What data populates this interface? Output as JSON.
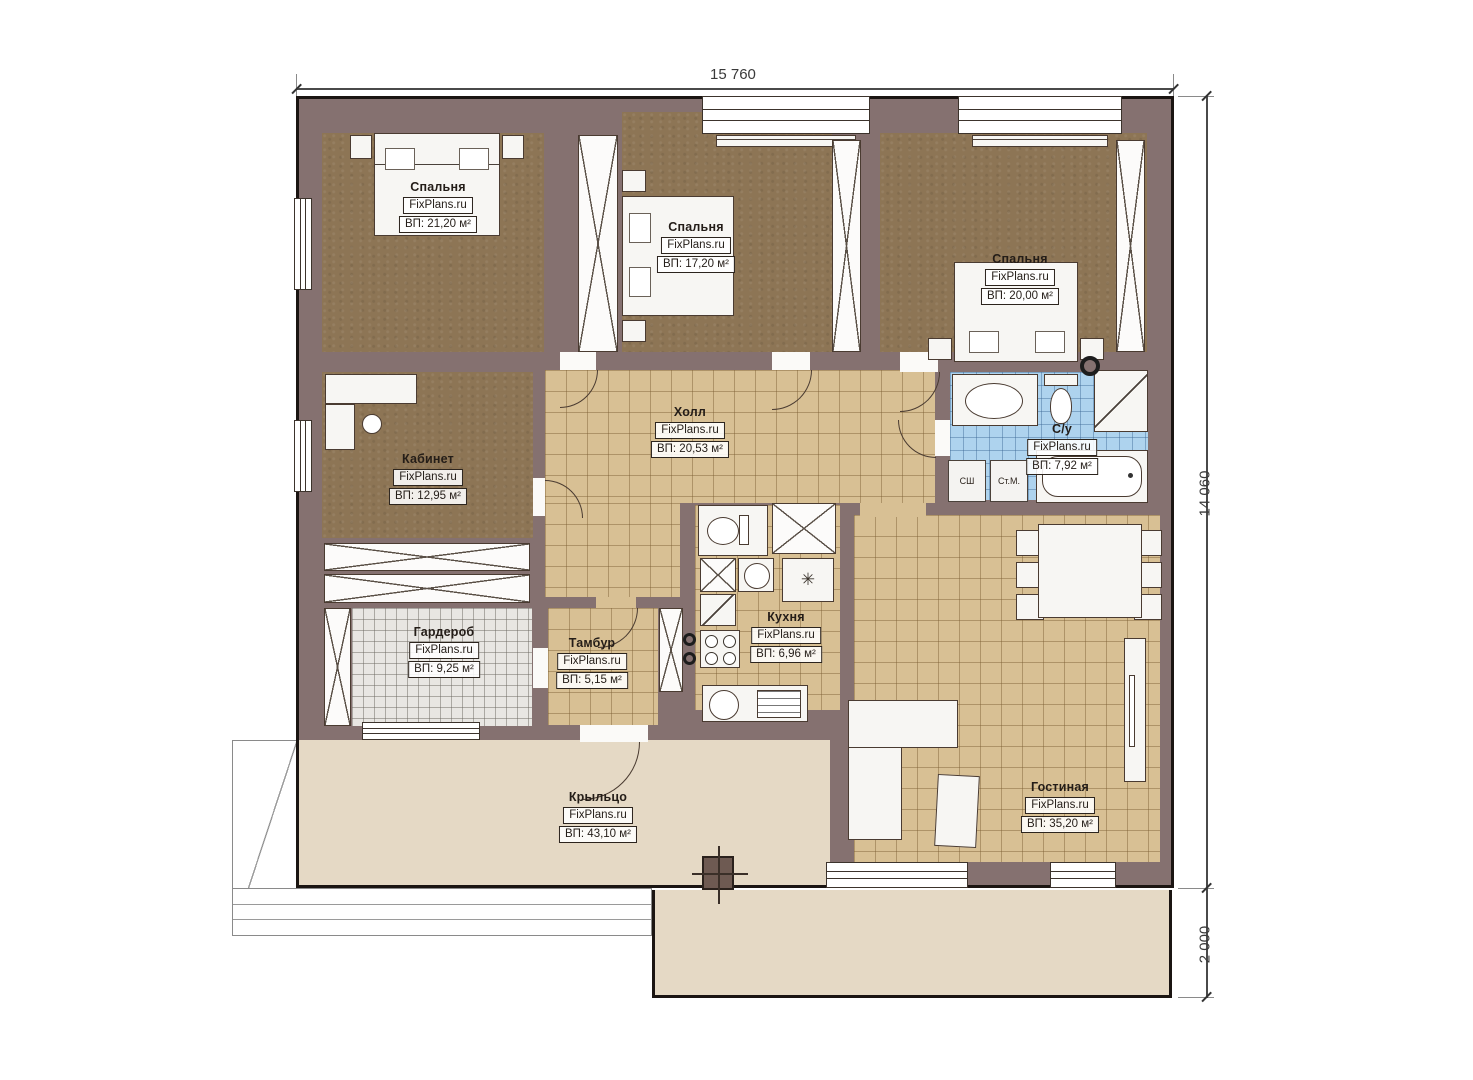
{
  "watermark": "FixPlans.ru",
  "dimensions": {
    "top_width": "15 760",
    "right_height": "14 060",
    "right_terrace": "2 000"
  },
  "rooms": [
    {
      "id": "bedroom-1",
      "name": "Спальня",
      "area": "ВП: 21,20 м²"
    },
    {
      "id": "bedroom-2",
      "name": "Спальня",
      "area": "ВП: 17,20 м²"
    },
    {
      "id": "bedroom-3",
      "name": "Спальня",
      "area": "ВП: 20,00 м²"
    },
    {
      "id": "office",
      "name": "Кабинет",
      "area": "ВП: 12,95 м²"
    },
    {
      "id": "hall",
      "name": "Холл",
      "area": "ВП: 20,53 м²"
    },
    {
      "id": "bathroom",
      "name": "С/у",
      "area": "ВП: 7,92 м²"
    },
    {
      "id": "wardrobe",
      "name": "Гардероб",
      "area": "ВП: 9,25 м²"
    },
    {
      "id": "tambour",
      "name": "Тамбур",
      "area": "ВП: 5,15 м²"
    },
    {
      "id": "kitchen",
      "name": "Кухня",
      "area": "ВП: 6,96 м²"
    },
    {
      "id": "living",
      "name": "Гостиная",
      "area": "ВП: 35,20 м²"
    },
    {
      "id": "porch",
      "name": "Крыльцо",
      "area": "ВП: 43,10 м²"
    }
  ],
  "labels": {
    "dryer": "СШ",
    "washing_machine": "Ст.М."
  },
  "icons": {
    "fridge_glyph": "✳"
  },
  "colors": {
    "wall": "#857170",
    "outline": "#1b1512",
    "bedroom_floor": "#8d7555",
    "tile_tan": "#d8c094",
    "tile_blue": "#aed3ee",
    "tile_gray": "#e8e6e2",
    "porch": "#e5d9c5",
    "furniture": "#f7f6f3",
    "line": "#4a3b31",
    "label_text": "#241d18"
  }
}
